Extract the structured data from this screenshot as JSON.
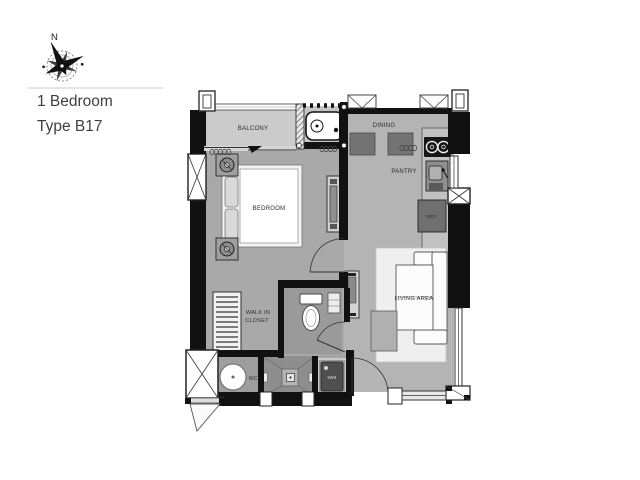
{
  "header": {
    "compass_north": "N",
    "title_line1": "1 Bedroom",
    "title_line2": "Type B17"
  },
  "rooms": {
    "balcony": "BALCONY",
    "dining": "DINING",
    "pantry": "PANTRY",
    "bedroom": "BEDROOM",
    "living_area": "LIVING AREA",
    "walk_in_closet_line1": "WALK IN",
    "walk_in_closet_line2": "CLOSET",
    "wc": "WC.",
    "wm": "WM",
    "refrigerator": "REF."
  },
  "colors": {
    "background": "#ffffff",
    "wall": "#111111",
    "floor_main": "#a9a9a9",
    "floor_open": "#b4b4b4",
    "floor_balcony": "#cbcbcb",
    "floor_bath": "#8e8e8e",
    "furniture_dark": "#737373",
    "title_text": "#3f3f3f",
    "label_text": "#2b2b2b"
  }
}
